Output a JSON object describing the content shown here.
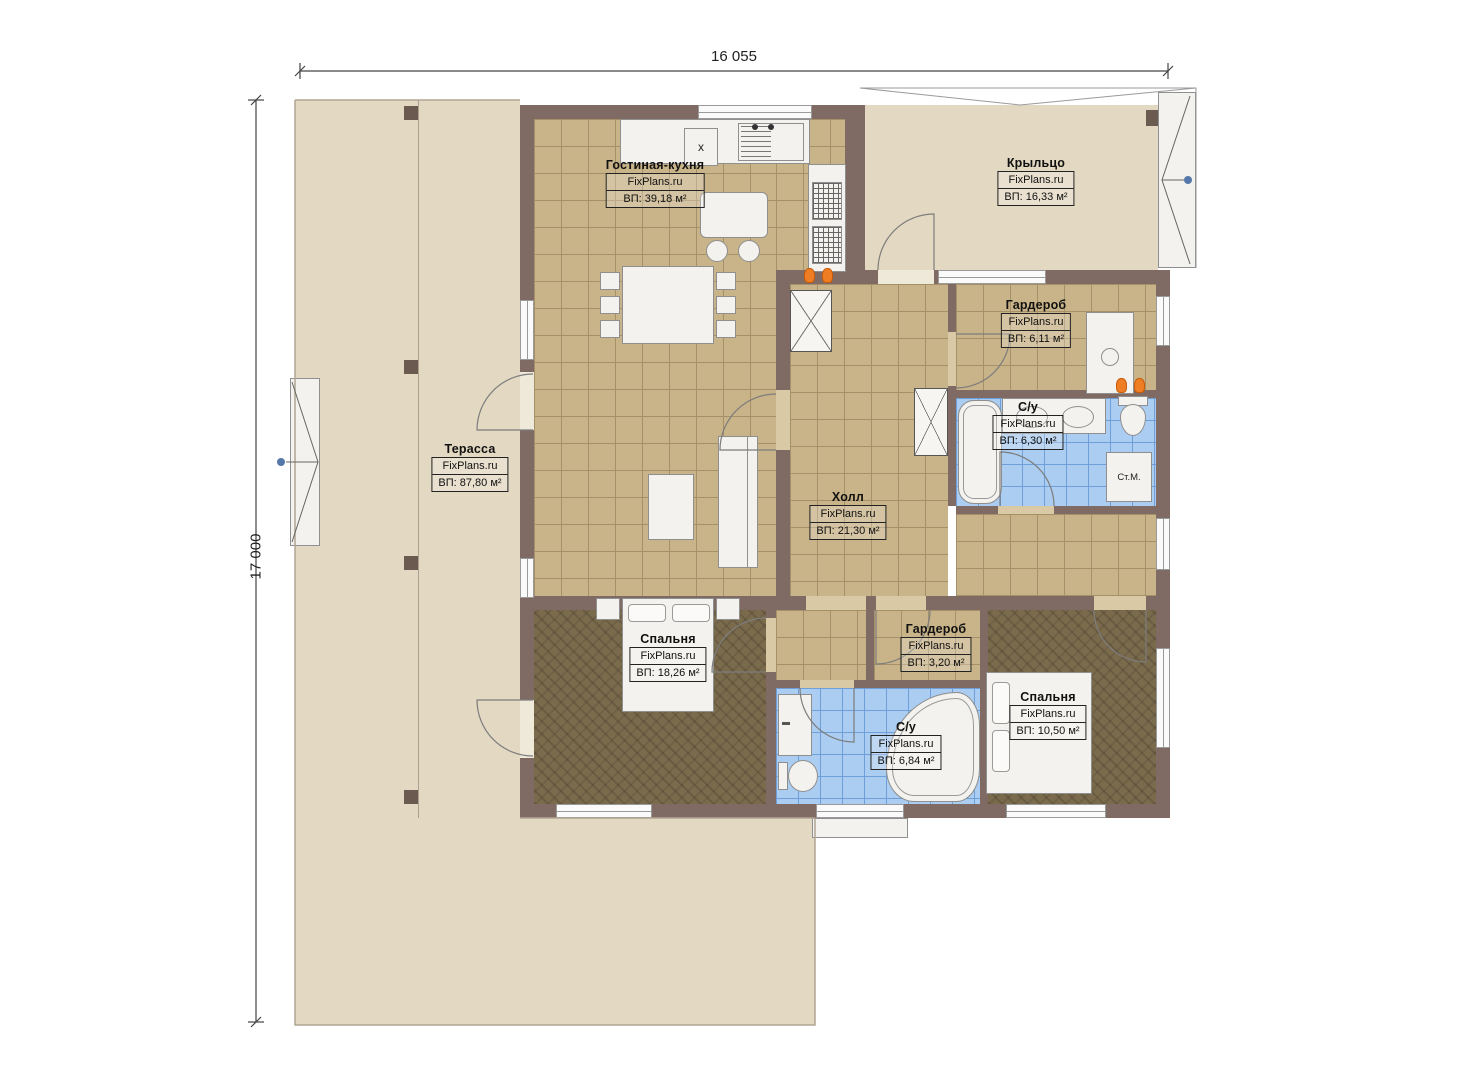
{
  "brand": "FixPlans.ru",
  "dimensions": {
    "width_label": "16 055",
    "height_label": "17 000"
  },
  "rooms": [
    {
      "id": "living-kitchen",
      "name": "Гостиная-кухня",
      "brand": "FixPlans.ru",
      "area": "ВП: 39,18 м²"
    },
    {
      "id": "porch",
      "name": "Крыльцо",
      "brand": "FixPlans.ru",
      "area": "ВП: 16,33 м²"
    },
    {
      "id": "terrace",
      "name": "Терасса",
      "brand": "FixPlans.ru",
      "area": "ВП: 87,80 м²"
    },
    {
      "id": "hall",
      "name": "Холл",
      "brand": "FixPlans.ru",
      "area": "ВП: 21,30 м²"
    },
    {
      "id": "wardrobe-top",
      "name": "Гардероб",
      "brand": "FixPlans.ru",
      "area": "ВП: 6,11 м²"
    },
    {
      "id": "bathroom-top",
      "name": "С/у",
      "brand": "FixPlans.ru",
      "area": "ВП: 6,30 м²"
    },
    {
      "id": "bedroom-left",
      "name": "Спальня",
      "brand": "FixPlans.ru",
      "area": "ВП: 18,26 м²"
    },
    {
      "id": "wardrobe-small",
      "name": "Гардероб",
      "brand": "FixPlans.ru",
      "area": "ВП: 3,20 м²"
    },
    {
      "id": "bathroom-bottom",
      "name": "С/у",
      "brand": "FixPlans.ru",
      "area": "ВП: 6,84 м²"
    },
    {
      "id": "bedroom-right",
      "name": "Спальня",
      "brand": "FixPlans.ru",
      "area": "ВП: 10,50 м²"
    }
  ],
  "appliances": {
    "washing_machine": "Ст.М.",
    "fridge_mark": "x"
  },
  "colors": {
    "wall": "#806b64",
    "tile_tan": "#c9b388",
    "tile_blue": "#abcdf1",
    "carpet": "#7b6b4d",
    "terrace": "#e3d9c3",
    "radiator": "#ee7d23",
    "marker_dot": "#5577aa"
  }
}
